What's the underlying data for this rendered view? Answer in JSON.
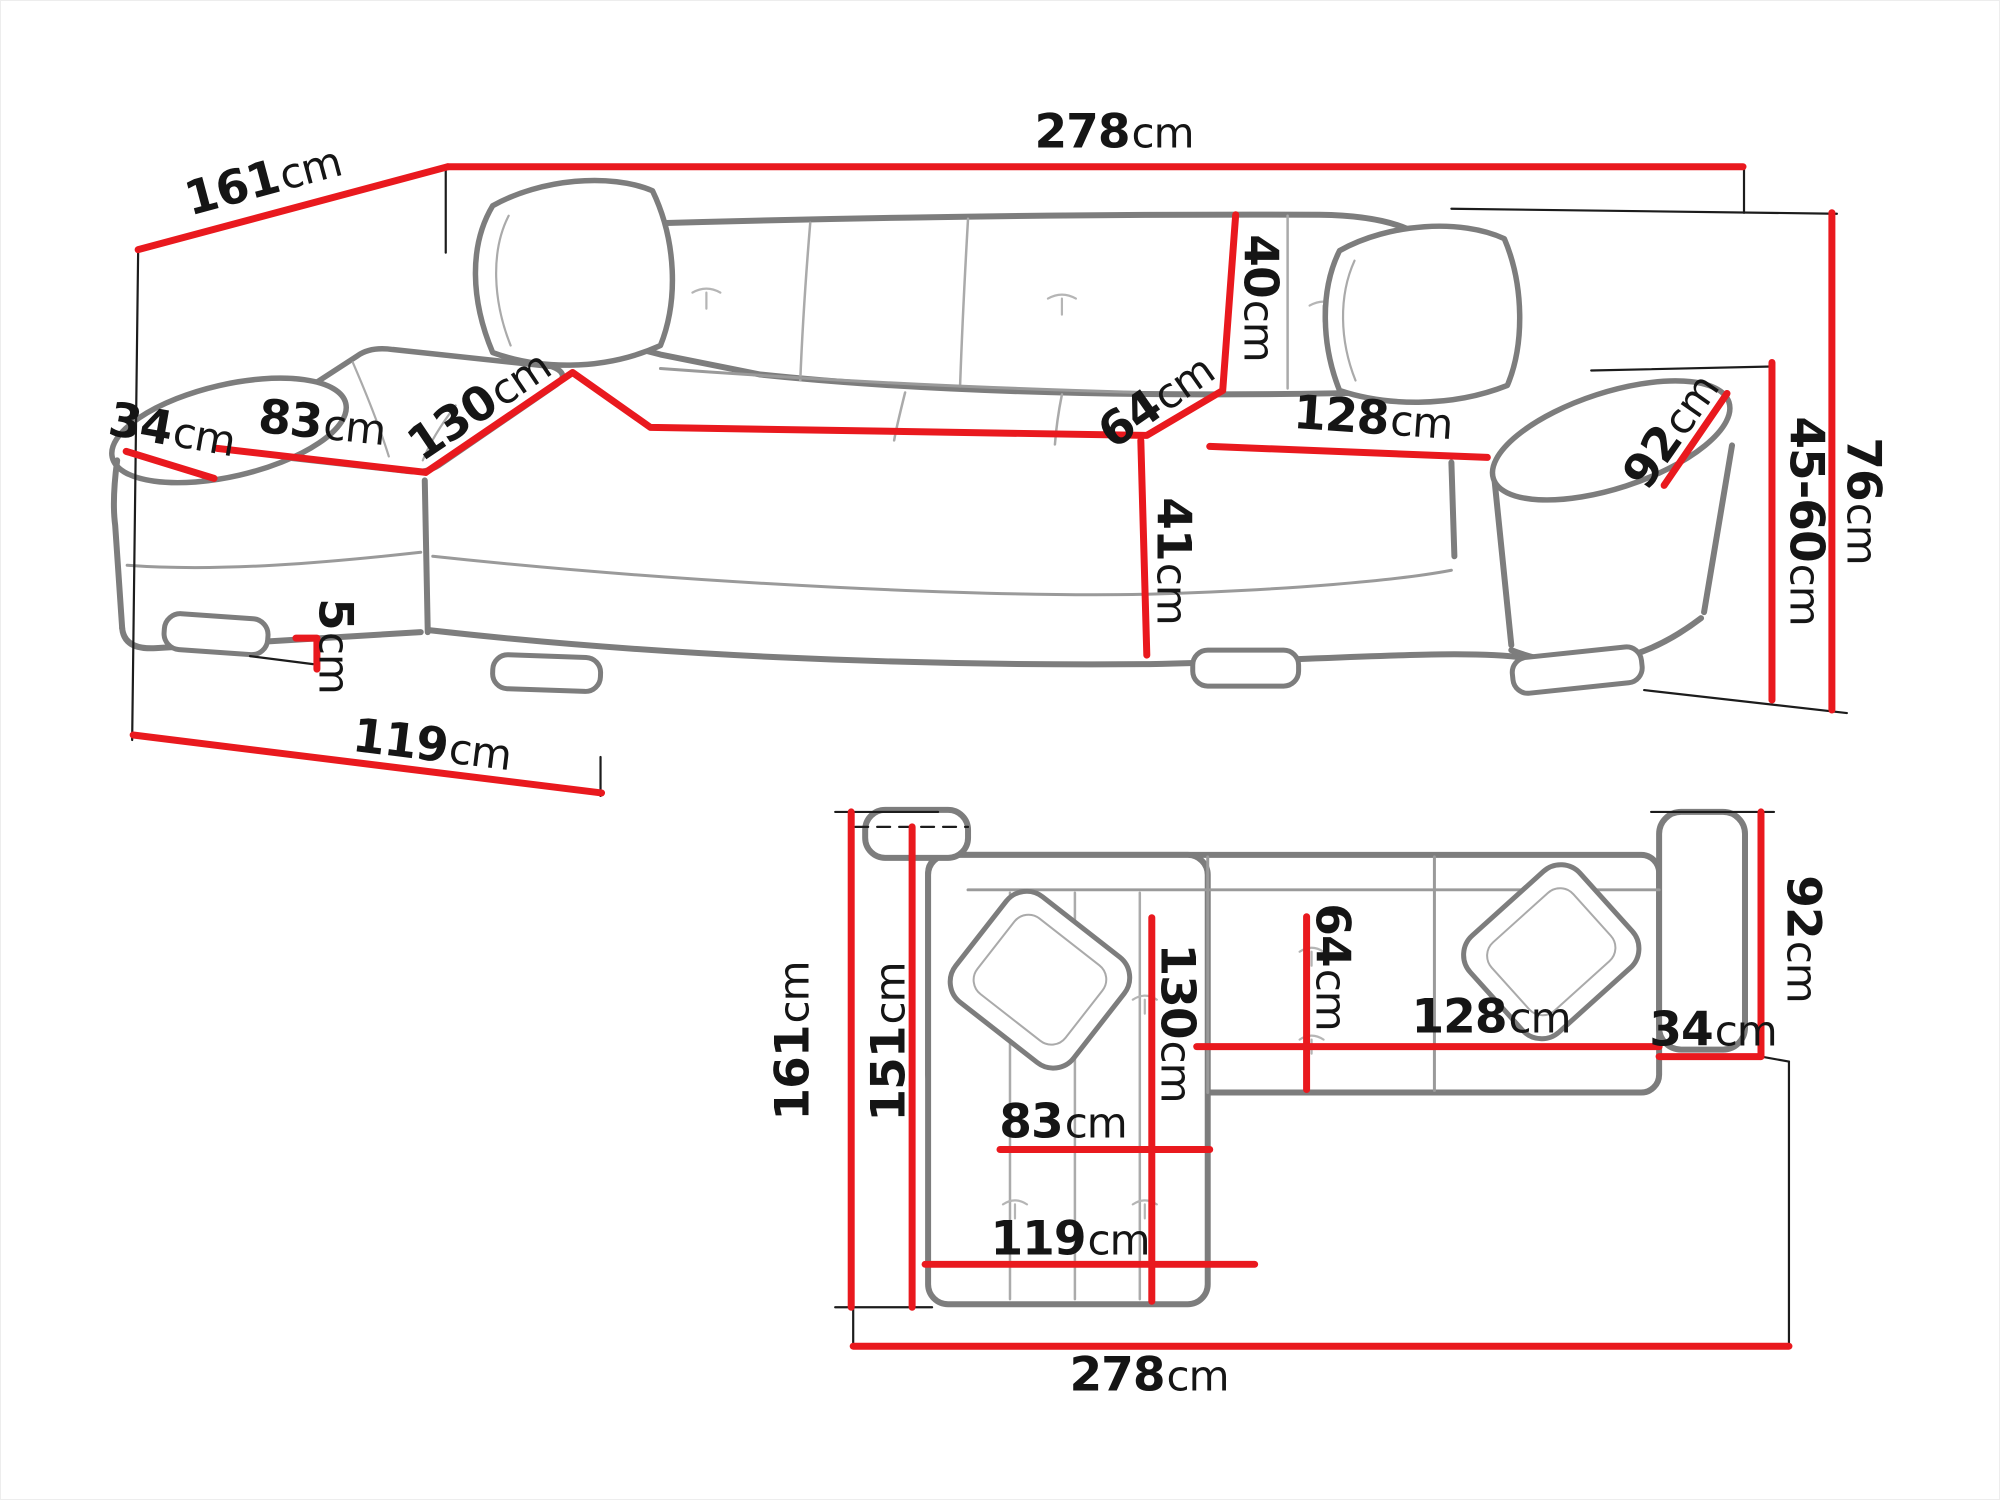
{
  "diagram": {
    "type": "corner-sofa-dimension-diagram",
    "unit_system": "cm"
  },
  "colors": {
    "dimension_line": "#e9191e",
    "sofa_outline": "#7d7d7d",
    "seam_gray": "#aaaaaa",
    "extension_line": "#1c1c1c",
    "label_text": "#151515",
    "background": "#ffffff"
  },
  "perspective_view": {
    "dims": {
      "d161": {
        "value": "161",
        "unit": "cm"
      },
      "d278": {
        "value": "278",
        "unit": "cm"
      },
      "d34": {
        "value": "34",
        "unit": "cm"
      },
      "d83": {
        "value": "83",
        "unit": "cm"
      },
      "d130": {
        "value": "130",
        "unit": "cm"
      },
      "d40": {
        "value": "40",
        "unit": "cm"
      },
      "d64": {
        "value": "64",
        "unit": "cm"
      },
      "d128": {
        "value": "128",
        "unit": "cm"
      },
      "d41": {
        "value": "41",
        "unit": "cm"
      },
      "d92": {
        "value": "92",
        "unit": "cm"
      },
      "d76": {
        "value": "76",
        "unit": "cm"
      },
      "d4560": {
        "value": "45-60",
        "unit": "cm"
      },
      "d5": {
        "value": "5",
        "unit": "cm"
      },
      "d119": {
        "value": "119",
        "unit": "cm"
      }
    }
  },
  "plan_view": {
    "dims": {
      "d161": {
        "value": "161",
        "unit": "cm"
      },
      "d151": {
        "value": "151",
        "unit": "cm"
      },
      "d130": {
        "value": "130",
        "unit": "cm"
      },
      "d64": {
        "value": "64",
        "unit": "cm"
      },
      "d83": {
        "value": "83",
        "unit": "cm"
      },
      "d119": {
        "value": "119",
        "unit": "cm"
      },
      "d128": {
        "value": "128",
        "unit": "cm"
      },
      "d34": {
        "value": "34",
        "unit": "cm"
      },
      "d92": {
        "value": "92",
        "unit": "cm"
      },
      "d278": {
        "value": "278",
        "unit": "cm"
      }
    }
  }
}
